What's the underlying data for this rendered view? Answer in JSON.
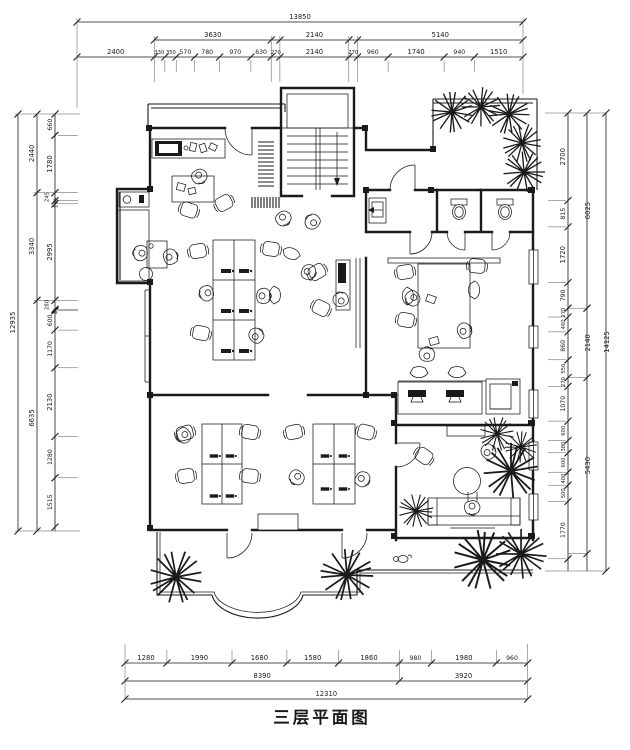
{
  "title": "三层平面图",
  "dims": {
    "top": {
      "overall": "13850",
      "row2": [
        "3630",
        "2140",
        "5140"
      ],
      "row3": [
        "2400",
        "330",
        "350",
        "570",
        "780",
        "970",
        "630",
        "270",
        "2140",
        "270",
        "960",
        "1740",
        "940",
        "1510"
      ]
    },
    "bottom": {
      "row1": [
        "1280",
        "1990",
        "1680",
        "1580",
        "1860",
        "980",
        "1980",
        "960"
      ],
      "row2": [
        "8390",
        "3920"
      ],
      "overall": "12310"
    },
    "left": {
      "overall": "12935",
      "col2": [
        "2440",
        "3340",
        "6635"
      ],
      "col3": [
        "660",
        "1780",
        "245",
        "100",
        "2995",
        "280",
        "45",
        "600",
        "1170",
        "2130",
        "1280",
        "1515"
      ]
    },
    "right": {
      "overall": "14125",
      "col2": [
        "6025",
        "2140",
        "5430"
      ],
      "col3": [
        "2700",
        "815",
        "1720",
        "790",
        "270",
        "460",
        "860",
        "550",
        "270",
        "1070",
        "600",
        "380",
        "600",
        "400",
        "500",
        "1770"
      ]
    }
  },
  "colors": {
    "ink": "#1a1a1a",
    "paper": "#ffffff"
  }
}
